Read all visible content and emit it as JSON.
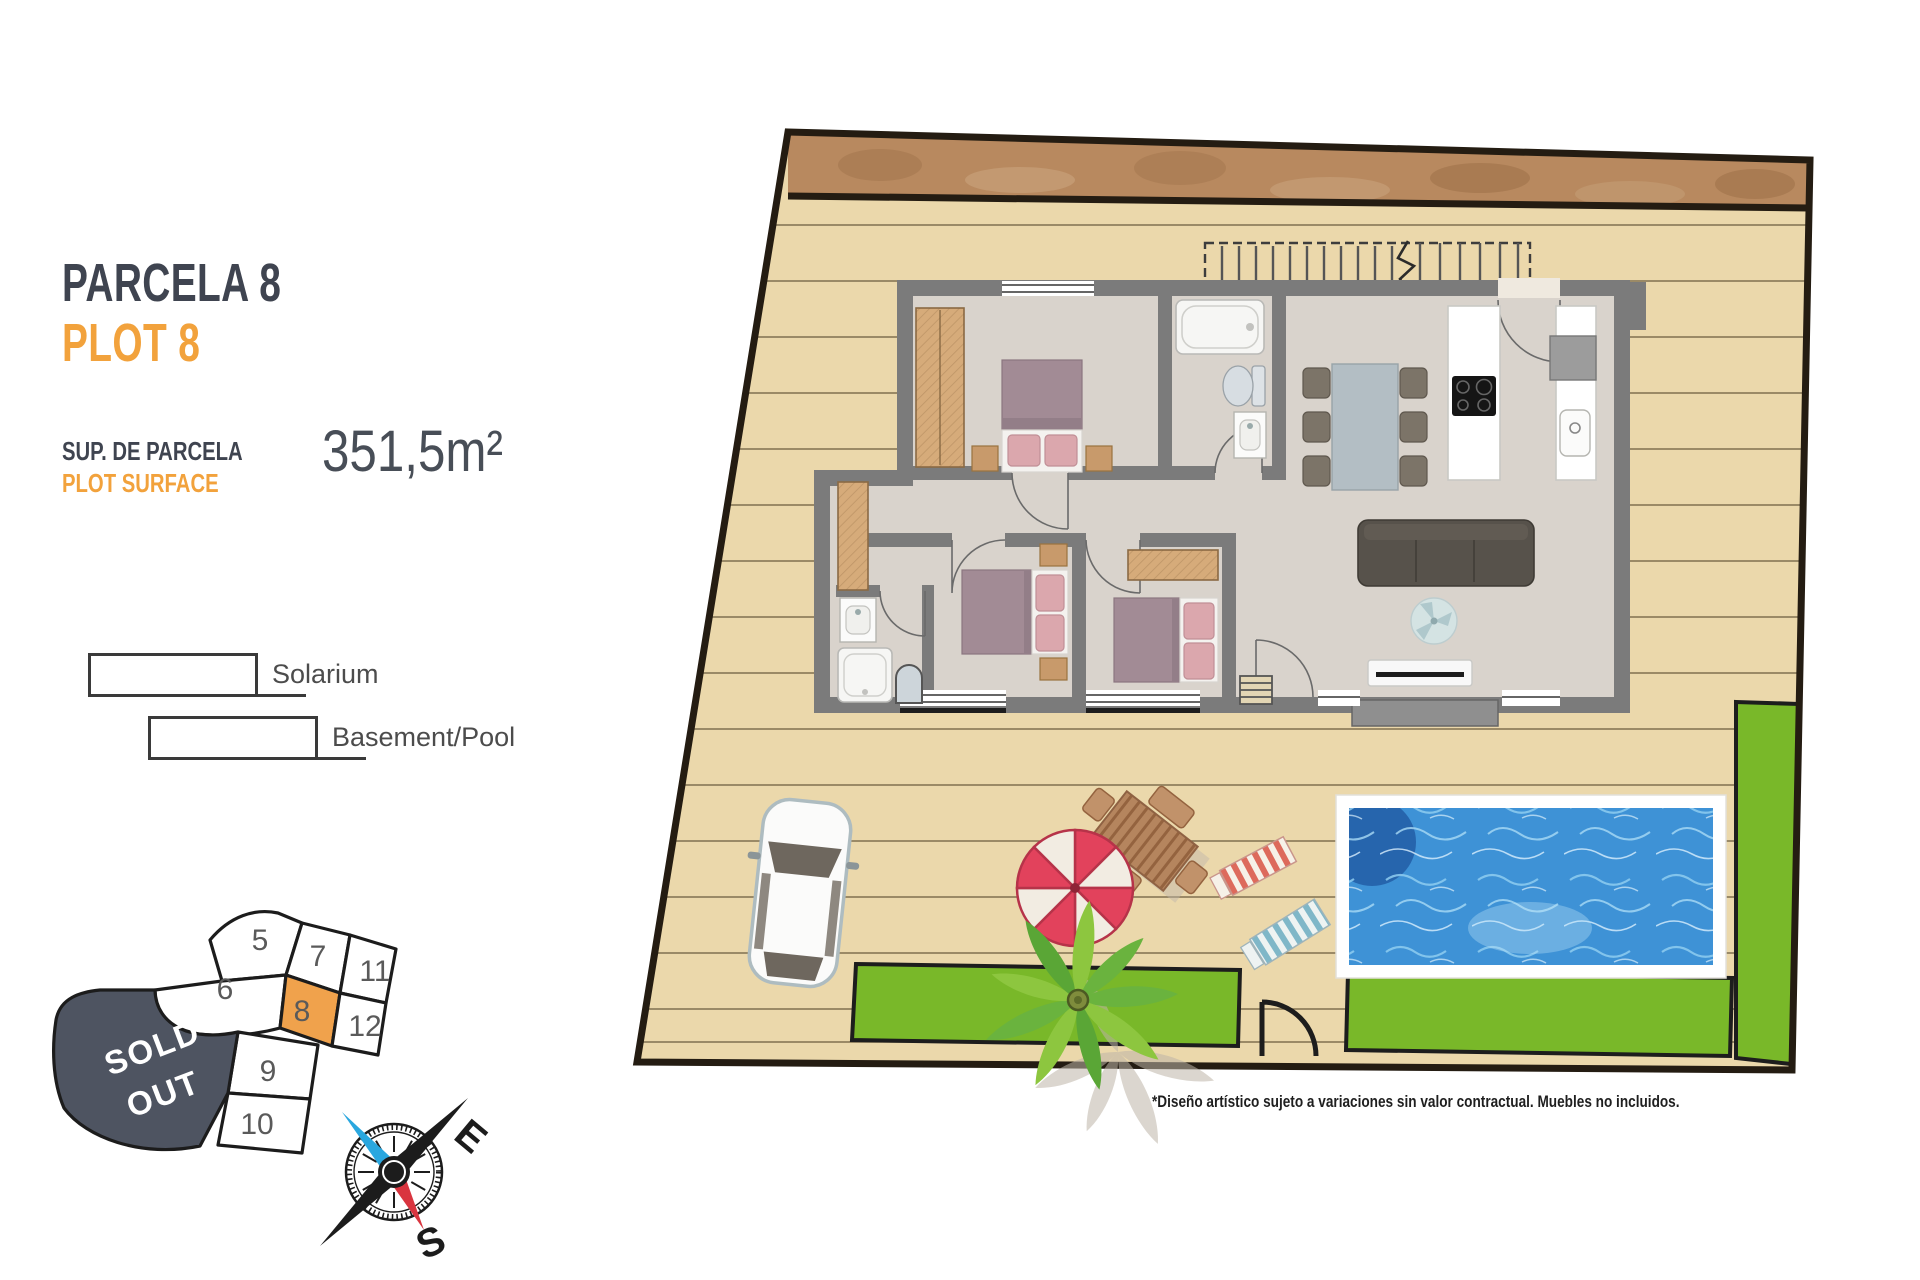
{
  "panel": {
    "title_primary": "PARCELA 8",
    "title_secondary": "PLOT 8",
    "surface_label_primary": "SUP. DE PARCELA",
    "surface_label_secondary": "PLOT SURFACE",
    "surface_value": "351,5m²"
  },
  "legend": {
    "items": [
      {
        "label": "Solarium"
      },
      {
        "label": "Basement/Pool"
      }
    ]
  },
  "site_map": {
    "sold_out_line1": "SOLD",
    "sold_out_line2": "OUT",
    "highlighted_plot": "8",
    "plots": [
      "5",
      "7",
      "11",
      "6",
      "8",
      "12",
      "9",
      "10"
    ]
  },
  "compass": {
    "east": "E",
    "south": "S"
  },
  "footer": {
    "disclaimer": "*Diseño artístico sujeto a variaciones sin valor contractual. Muebles no incluidos."
  },
  "colors": {
    "accent_orange": "#F2A23C",
    "heading_gray": "#3F4450",
    "sold_out_bg": "#4E5461",
    "deck_tan": "#EBD8AB",
    "pool_water": "#3E92D6",
    "garden_green": "#79B829",
    "wall_gray": "#7B7B7B",
    "rock_brown": "#B8895F"
  }
}
